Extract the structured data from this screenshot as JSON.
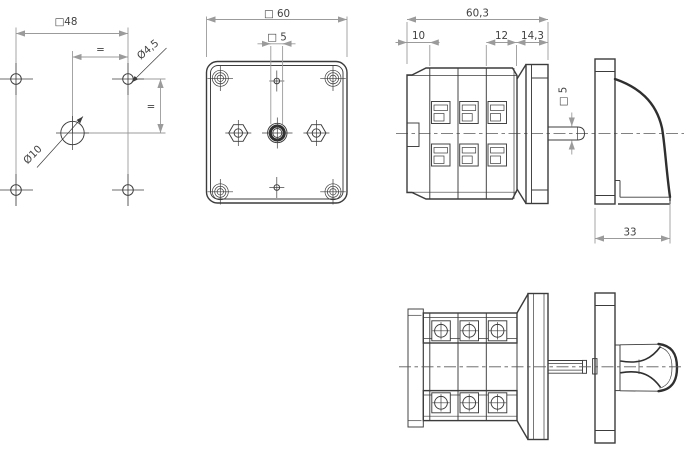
{
  "drawing": {
    "background": "#ffffff",
    "line_color": "#3c3c3c",
    "dim_color": "#9b9b9b",
    "text_color": "#414141",
    "views": {
      "drilling_plan": {
        "dims": {
          "bolt_circle_square": "□48",
          "equal_spacing_horizontal": "=",
          "equal_spacing_vertical": "=",
          "fixing_hole_diameter": "Ø4,5",
          "center_hole_diameter": "Ø10"
        }
      },
      "front": {
        "dims": {
          "faceplate_square": "□ 60",
          "shaft_square": "□ 5"
        }
      },
      "side": {
        "dims": {
          "total_depth": "60,3",
          "front_section": "10",
          "terminal_pitch": "12",
          "rear_section": "14,3",
          "shaft_square": "□ 5",
          "handle_depth": "33"
        }
      }
    }
  }
}
